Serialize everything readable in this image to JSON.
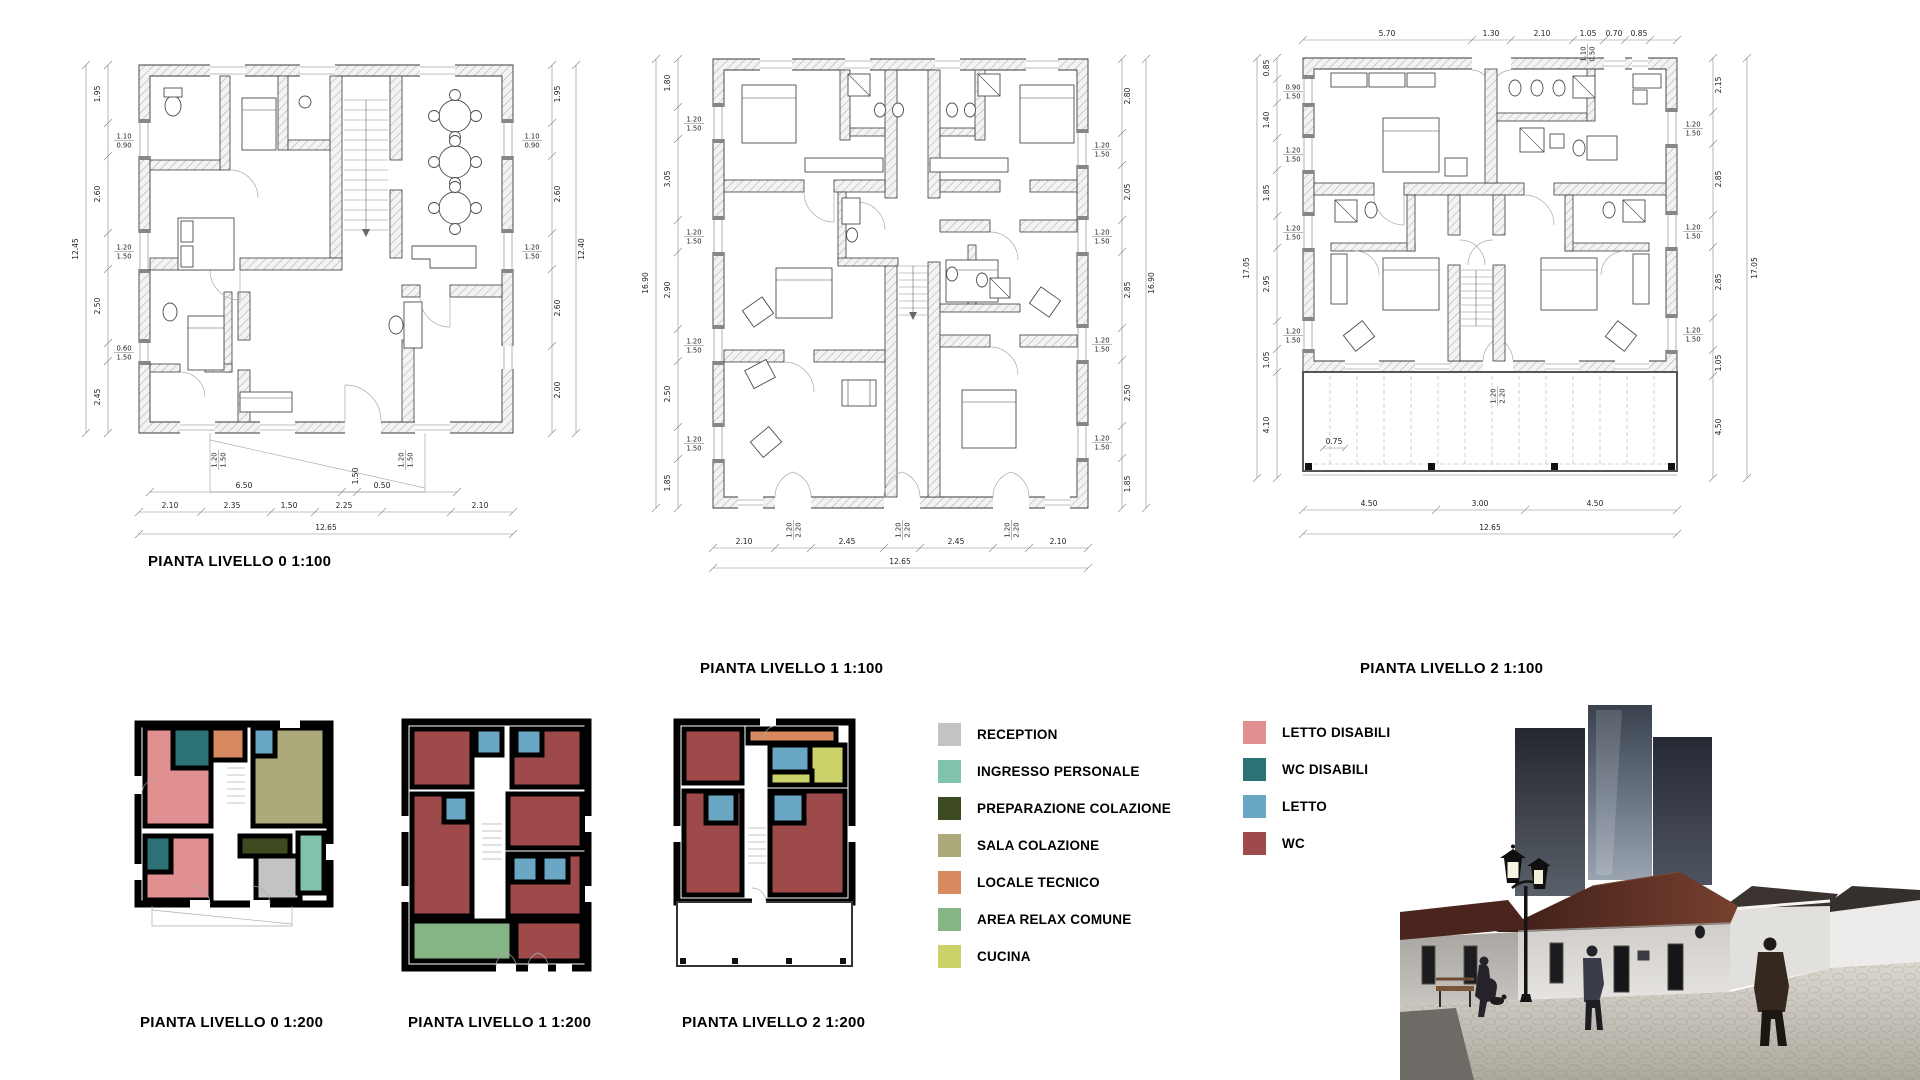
{
  "titles": {
    "plan0_100": "PIANTA LIVELLO 0 1:100",
    "plan1_100": "PIANTA LIVELLO 1 1:100",
    "plan2_100": "PIANTA LIVELLO 2 1:100",
    "plan0_200": "PIANTA LIVELLO 0 1:200",
    "plan1_200": "PIANTA LIVELLO 1 1:200",
    "plan2_200": "PIANTA LIVELLO 2 1:200"
  },
  "legend": {
    "column1": [
      {
        "label": "RECEPTION",
        "color": "#c3c3c3"
      },
      {
        "label": "INGRESSO PERSONALE",
        "color": "#7fc3ac"
      },
      {
        "label": "PREPARAZIONE COLAZIONE",
        "color": "#3e4a1f"
      },
      {
        "label": "SALA COLAZIONE",
        "color": "#aca97b"
      },
      {
        "label": "LOCALE TECNICO",
        "color": "#d78a60"
      },
      {
        "label": "AREA RELAX COMUNE",
        "color": "#86b585"
      },
      {
        "label": "CUCINA",
        "color": "#ccd26a"
      }
    ],
    "column2": [
      {
        "label": "LETTO DISABILI",
        "color": "#e09090"
      },
      {
        "label": "WC DISABILI",
        "color": "#2c7173"
      },
      {
        "label": "LETTO",
        "color": "#6aa7c5"
      },
      {
        "label": "WC",
        "color": "#9e4a4a"
      }
    ]
  },
  "dims": {
    "p0": {
      "overall_left": "12.45",
      "overall_right": "12.40",
      "overall_bottom": "12.65",
      "left": [
        "1.95",
        "2.60",
        "2.50",
        "2.45"
      ],
      "left_small": [
        "1.10",
        "0.90",
        "1.20",
        "1.50",
        "0.60",
        "1.50"
      ],
      "right": [
        "1.95",
        "2.60",
        "2.60",
        "2.00"
      ],
      "right_small": [
        "1.10",
        "0.90",
        "1.20",
        "1.50"
      ],
      "bottom_mid": [
        "6.50",
        "0.50"
      ],
      "bottom": [
        "2.10",
        "2.35",
        "1.50",
        "2.25",
        "2.10"
      ],
      "bottom_small": [
        "1.20",
        "1.50",
        "1.50",
        "1.20",
        "1.50"
      ]
    },
    "p1": {
      "overall_left": "16.90",
      "overall_right": "16.90",
      "overall_bottom": "12.65",
      "left": [
        "1.80",
        "3.05",
        "2.90",
        "2.50",
        "1.85"
      ],
      "left_small": [
        "1.20",
        "1.50",
        "1.20",
        "1.50",
        "1.20",
        "1.50",
        "1.20",
        "1.50"
      ],
      "right": [
        "2.80",
        "2.05",
        "2.85",
        "2.50",
        "1.85"
      ],
      "right_small": [
        "1.20",
        "1.50",
        "1.20",
        "1.50",
        "1.20",
        "1.50",
        "1.20",
        "1.50"
      ],
      "bottom": [
        "2.10",
        "2.45",
        "2.45",
        "2.10"
      ],
      "bottom_small": [
        "1.20",
        "2.20",
        "1.20",
        "2.20",
        "1.20",
        "2.20"
      ]
    },
    "p2": {
      "overall_left": "17.05",
      "overall_right": "17.05",
      "overall_bottom": "12.65",
      "top": [
        "5.70",
        "1.30",
        "2.10",
        "1.05",
        "0.70",
        "0.85"
      ],
      "top_small": [
        "1.10",
        "0.50"
      ],
      "left": [
        "0.85",
        "1.40",
        "1.85",
        "2.95",
        "1.05",
        "4.10"
      ],
      "left_small": [
        "0.90",
        "1.50",
        "1.20",
        "1.50",
        "1.20",
        "1.50",
        "1.20",
        "1.50"
      ],
      "right": [
        "2.15",
        "2.85",
        "2.85",
        "1.05",
        "4.50"
      ],
      "right_small": [
        "1.20",
        "1.50",
        "1.20",
        "1.50",
        "1.20",
        "1.50"
      ],
      "bottom": [
        "4.50",
        "3.00",
        "4.50"
      ],
      "door_small": [
        "1.20",
        "2.20"
      ],
      "terrace": "0.75"
    }
  }
}
